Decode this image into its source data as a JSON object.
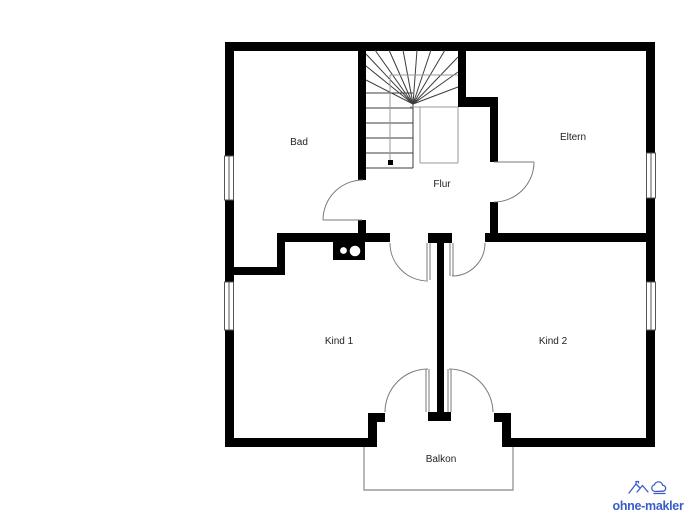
{
  "canvas": {
    "width": 693,
    "height": 520,
    "background": "#ffffff"
  },
  "floorplan": {
    "wall_color": "#000000",
    "door_line_color": "#7a7a7a",
    "stair_line_color": "#3c3c3c",
    "thin_line_color": "#9a9a9a",
    "balcony_line_color": "#888888",
    "window_line_color": "#555555",
    "label_color": "#222222",
    "rooms": [
      {
        "name": "bad",
        "label": "Bad"
      },
      {
        "name": "eltern",
        "label": "Eltern"
      },
      {
        "name": "flur",
        "label": "Flur"
      },
      {
        "name": "kind-1",
        "label": "Kind 1"
      },
      {
        "name": "kind-2",
        "label": "Kind 2"
      },
      {
        "name": "balkon",
        "label": "Balkon"
      }
    ],
    "features": {
      "staircase": "winder-stairs-top-center",
      "balcony": "bottom-center-with-double-door",
      "shaft": "black-box-two-white-circles",
      "windows": 4,
      "doors": 6
    }
  },
  "branding": {
    "logo_text": "ohne-makler",
    "logo_color": "#3a5dc7",
    "logo_icon": "mountains-and-cloud-icon"
  }
}
